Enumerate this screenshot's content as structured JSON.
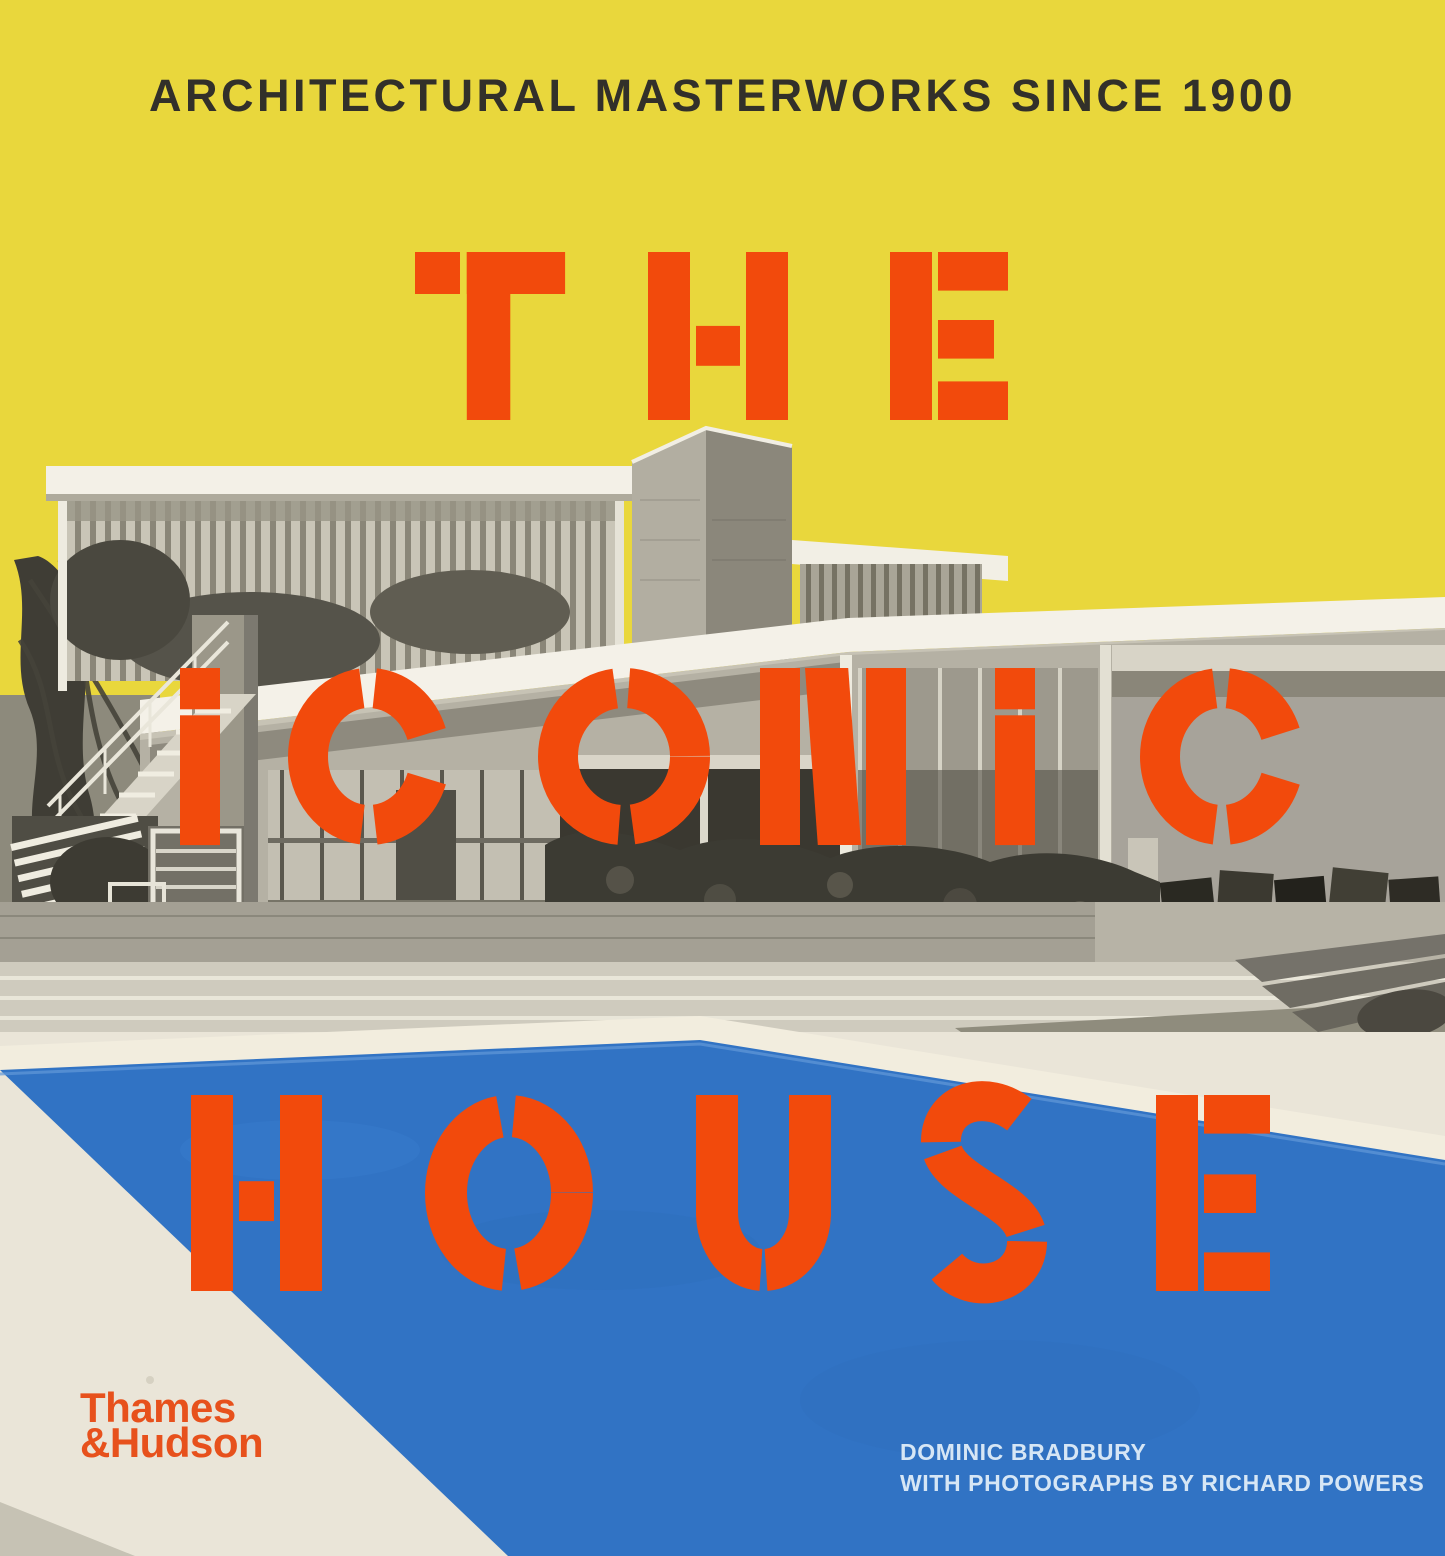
{
  "cover": {
    "tagline": "ARCHITECTURAL MASTERWORKS SINCE 1900",
    "title": {
      "words": [
        "THE",
        "ICONIC",
        "HOUSE"
      ]
    },
    "publisher": {
      "name_line1": "Thames",
      "name_line2": "&Hudson"
    },
    "credits": {
      "author": "DOMINIC BRADBURY",
      "photography": "WITH PHOTOGRAPHS BY RICHARD POWERS"
    },
    "colors": {
      "sky_yellow": "#e9d73c",
      "title_orange": "#f24a0c",
      "pool_blue": "#3173c4",
      "deck_offwhite": "#eae5d8",
      "tagline_ink": "#32302a",
      "publisher_orange": "#e7511c",
      "credits_text": "#d6e6f5"
    }
  }
}
